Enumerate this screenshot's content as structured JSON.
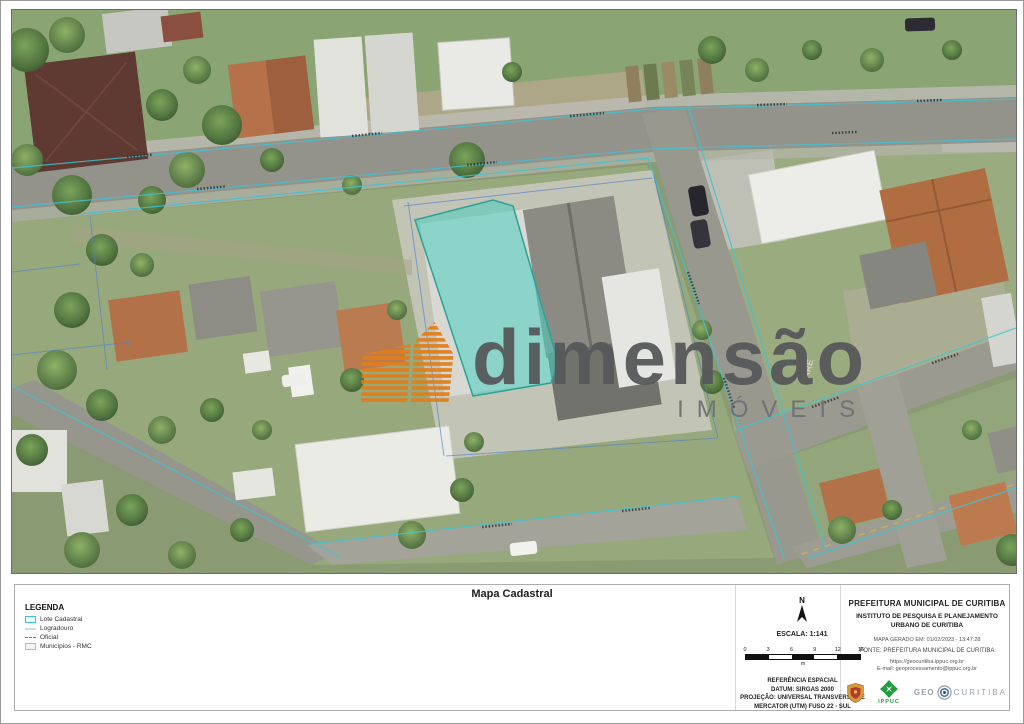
{
  "panel": {
    "title": "Mapa Cadastral"
  },
  "legend": {
    "title": "LEGENDA",
    "items": [
      {
        "label": "Lote Cadastral",
        "swatch_color": "#3fc3d4"
      },
      {
        "label": "Logradouro",
        "swatch_color": "#bfe3ea"
      },
      {
        "label": "Oficial",
        "swatch_color": "#777777"
      },
      {
        "label": "Municípios - RMC",
        "swatch_color": "#bbbbbb"
      }
    ]
  },
  "compass": {
    "label": "N"
  },
  "scale": {
    "label": "ESCALA: 1:141",
    "ticks": [
      "0",
      "3",
      "6",
      "9",
      "12",
      "15"
    ],
    "unit": "m"
  },
  "reference": {
    "text": "REFERÊNCIA ESPACIAL\nDATUM: SIRGAS 2000\nPROJEÇÃO: UNIVERSAL TRANSVERSA DE\nMERCATOR (UTM) FUSO 22 - SUL"
  },
  "agency": {
    "name": "PREFEITURA MUNICIPAL DE CURITIBA",
    "institute": "INSTITUTO DE PESQUISA E PLANEJAMENTO URBANO DE CURITIBA",
    "generated": "MAPA GERADO EM: 01/02/2023 - 13:47:28",
    "source": "FONTE: PREFEITURA MUNICIPAL DE CURITIBA",
    "url": "https://geocuritiba.ippuc.org.br",
    "email": "E-mail: geoprocessamento@ippuc.org.br"
  },
  "logos": {
    "ippuc": "IPPUC",
    "geo_prefix": "GEO",
    "geo_suffix": "CURITIBA"
  },
  "watermark": {
    "brand": "dimensão",
    "sub": "IMÓVEIS",
    "logo_color": "#e07f1d"
  },
  "map": {
    "road_marking": "PARE",
    "highlight_fill": "#4dcdc0",
    "highlight_stroke": "#2aa396",
    "parcel_line_color": "#3fc3d4",
    "lot_line_color": "#4d82cc"
  }
}
